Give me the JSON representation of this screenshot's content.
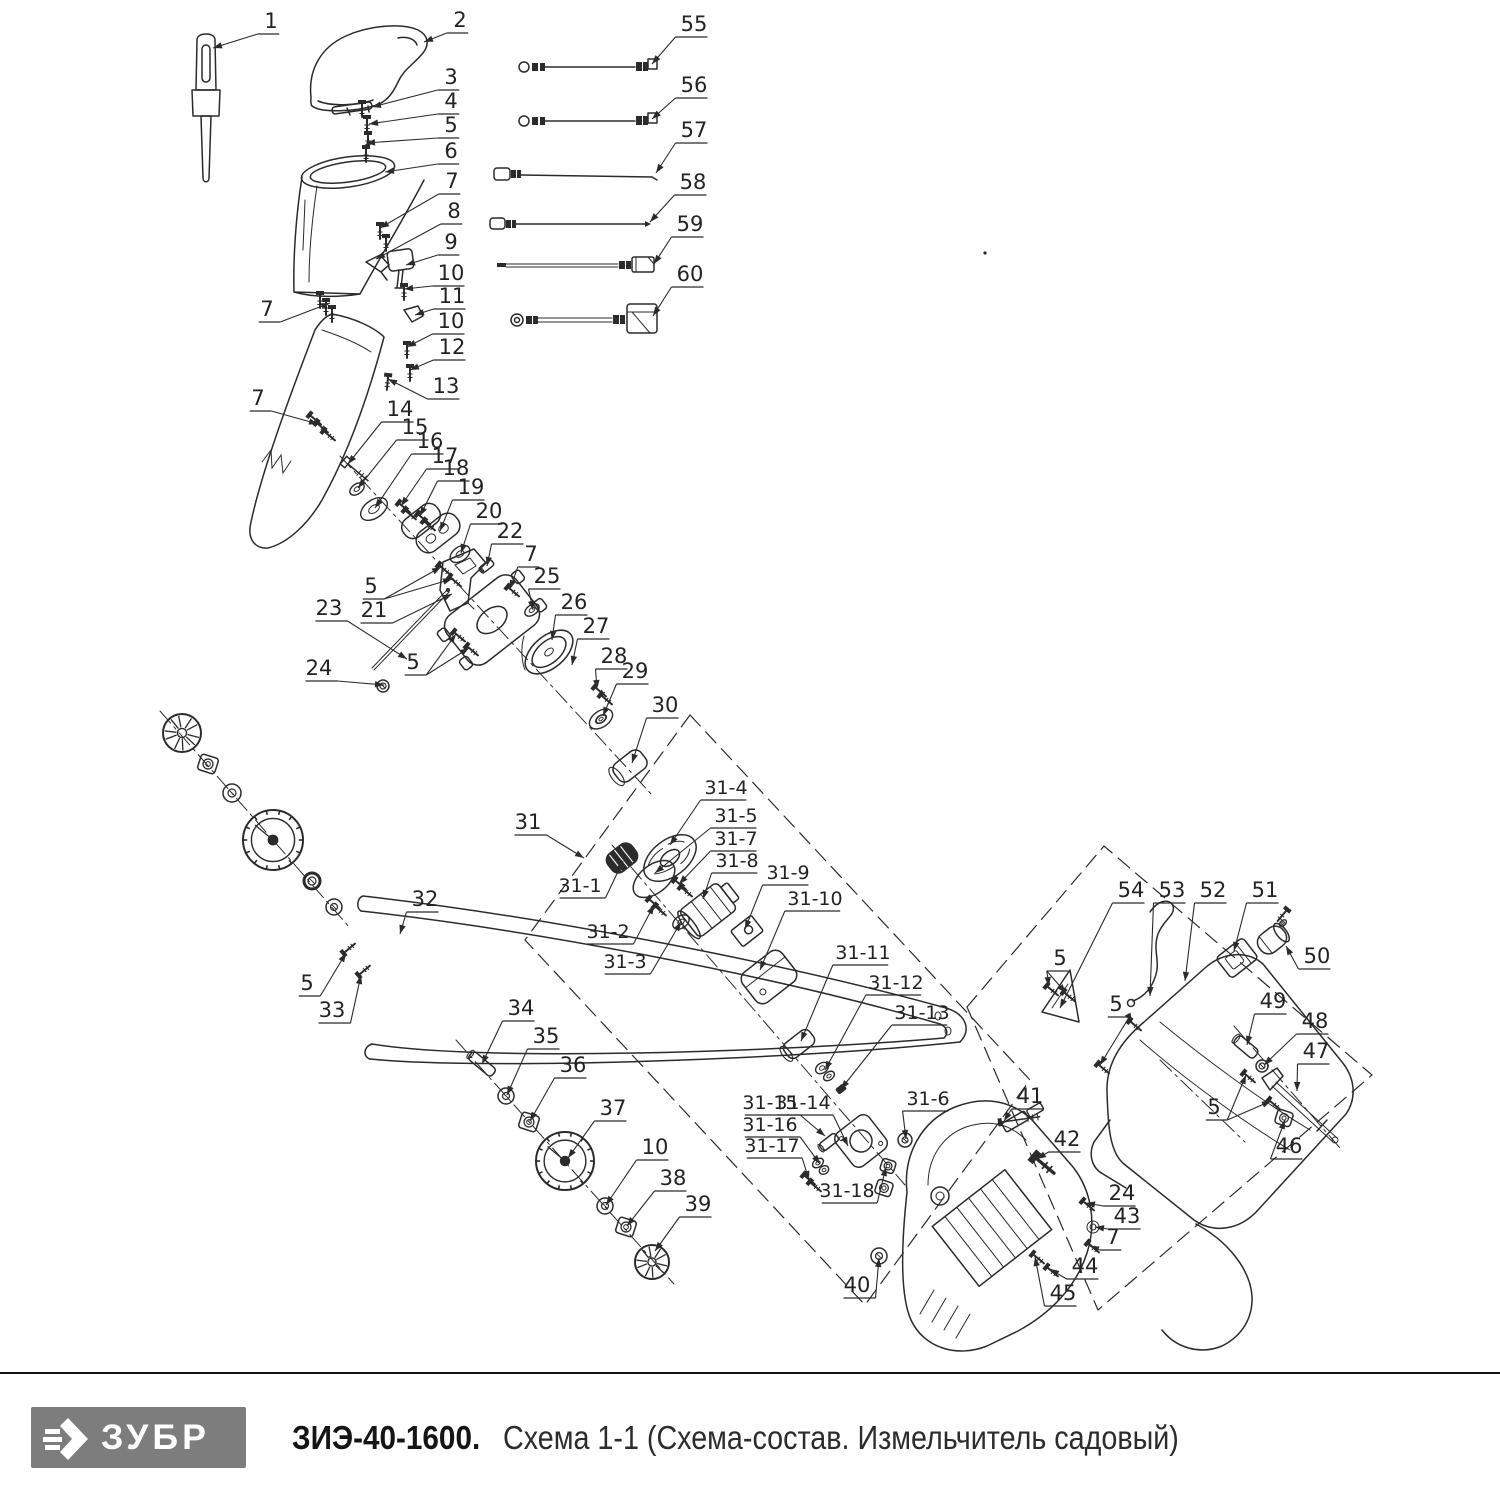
{
  "footer": {
    "brand": "ЗУБР",
    "model": "ЗИЭ-40-1600.",
    "subtitle": "Схема 1-1 (Схема-состав. Измельчитель садовый)"
  },
  "colors": {
    "line": "#2b2b2b",
    "logo_bg": "#7d7d7d",
    "logo_text": "#ffffff",
    "model_color": "#151515",
    "subtitle_color": "#2c2c2c"
  },
  "callouts": [
    {
      "l": "1",
      "x": 271,
      "y": 21,
      "t": [
        [
          213,
          48
        ]
      ]
    },
    {
      "l": "2",
      "x": 460,
      "y": 20,
      "t": [
        [
          424,
          42
        ]
      ]
    },
    {
      "l": "3",
      "x": 451,
      "y": 77,
      "t": [
        [
          372,
          107
        ]
      ]
    },
    {
      "l": "4",
      "x": 451,
      "y": 101,
      "t": [
        [
          369,
          124
        ]
      ]
    },
    {
      "l": "5",
      "x": 451,
      "y": 125,
      "t": [
        [
          366,
          143
        ]
      ]
    },
    {
      "l": "6",
      "x": 451,
      "y": 151,
      "t": [
        [
          385,
          172
        ]
      ]
    },
    {
      "l": "7",
      "x": 452,
      "y": 181,
      "t": [
        [
          380,
          228
        ]
      ]
    },
    {
      "l": "8",
      "x": 454,
      "y": 211,
      "t": [
        [
          376,
          259
        ]
      ]
    },
    {
      "l": "9",
      "x": 451,
      "y": 242,
      "t": [
        [
          406,
          265
        ]
      ]
    },
    {
      "l": "10",
      "x": 451,
      "y": 273,
      "t": [
        [
          404,
          289
        ]
      ]
    },
    {
      "l": "11",
      "x": 452,
      "y": 296,
      "t": [
        [
          415,
          315
        ]
      ]
    },
    {
      "l": "10",
      "x": 451,
      "y": 321,
      "t": [
        [
          407,
          347
        ]
      ]
    },
    {
      "l": "12",
      "x": 452,
      "y": 347,
      "t": [
        [
          410,
          370
        ]
      ]
    },
    {
      "l": "13",
      "x": 446,
      "y": 386,
      "t": [
        [
          388,
          379
        ]
      ]
    },
    {
      "l": "7",
      "x": 267,
      "y": 309,
      "t": [
        [
          330,
          303
        ]
      ]
    },
    {
      "l": "7",
      "x": 258,
      "y": 398,
      "t": [
        [
          318,
          424
        ]
      ]
    },
    {
      "l": "55",
      "x": 694,
      "y": 24,
      "t": [
        [
          652,
          64
        ]
      ]
    },
    {
      "l": "56",
      "x": 694,
      "y": 85,
      "t": [
        [
          652,
          119
        ]
      ]
    },
    {
      "l": "57",
      "x": 694,
      "y": 130,
      "t": [
        [
          656,
          173
        ]
      ]
    },
    {
      "l": "58",
      "x": 693,
      "y": 182,
      "t": [
        [
          650,
          222
        ]
      ]
    },
    {
      "l": "59",
      "x": 690,
      "y": 224,
      "t": [
        [
          654,
          264
        ]
      ]
    },
    {
      "l": "60",
      "x": 690,
      "y": 274,
      "t": [
        [
          653,
          316
        ]
      ]
    },
    {
      "l": "14",
      "x": 400,
      "y": 409,
      "t": [
        [
          348,
          464
        ]
      ]
    },
    {
      "l": "15",
      "x": 415,
      "y": 427,
      "t": [
        [
          358,
          488
        ]
      ]
    },
    {
      "l": "16",
      "x": 430,
      "y": 441,
      "t": [
        [
          375,
          508
        ]
      ]
    },
    {
      "l": "17",
      "x": 445,
      "y": 456,
      "t": [
        [
          401,
          506
        ]
      ]
    },
    {
      "l": "18",
      "x": 456,
      "y": 468,
      "t": [
        [
          420,
          516
        ]
      ]
    },
    {
      "l": "19",
      "x": 471,
      "y": 487,
      "t": [
        [
          440,
          531
        ]
      ]
    },
    {
      "l": "20",
      "x": 489,
      "y": 511,
      "t": [
        [
          461,
          553
        ]
      ]
    },
    {
      "l": "22",
      "x": 510,
      "y": 531,
      "t": [
        [
          487,
          566
        ]
      ]
    },
    {
      "l": "7",
      "x": 531,
      "y": 554,
      "t": [
        [
          510,
          589
        ]
      ]
    },
    {
      "l": "25",
      "x": 547,
      "y": 576,
      "t": [
        [
          533,
          610
        ]
      ]
    },
    {
      "l": "26",
      "x": 574,
      "y": 602,
      "t": [
        [
          552,
          640
        ]
      ]
    },
    {
      "l": "27",
      "x": 596,
      "y": 626,
      "t": [
        [
          572,
          665
        ]
      ]
    },
    {
      "l": "28",
      "x": 614,
      "y": 656,
      "t": [
        [
          597,
          689
        ]
      ]
    },
    {
      "l": "29",
      "x": 635,
      "y": 671,
      "t": [
        [
          603,
          716
        ]
      ]
    },
    {
      "l": "30",
      "x": 665,
      "y": 705,
      "t": [
        [
          632,
          763
        ]
      ]
    },
    {
      "l": "5",
      "x": 371,
      "y": 586,
      "t": [
        [
          441,
          567
        ],
        [
          452,
          579
        ]
      ]
    },
    {
      "l": "21",
      "x": 374,
      "y": 610,
      "t": [
        [
          452,
          594
        ]
      ]
    },
    {
      "l": "23",
      "x": 329,
      "y": 608,
      "t": [
        [
          407,
          659
        ]
      ]
    },
    {
      "l": "24",
      "x": 319,
      "y": 668,
      "t": [
        [
          384,
          685
        ]
      ]
    },
    {
      "l": "5",
      "x": 413,
      "y": 662,
      "t": [
        [
          456,
          634
        ],
        [
          469,
          648
        ]
      ]
    },
    {
      "l": "31",
      "x": 528,
      "y": 822,
      "t": [
        [
          584,
          858
        ]
      ]
    },
    {
      "l": "31-1",
      "x": 580,
      "y": 885,
      "t": [
        [
          623,
          861
        ]
      ]
    },
    {
      "l": "31-2",
      "x": 608,
      "y": 931,
      "t": [
        [
          654,
          905
        ]
      ]
    },
    {
      "l": "31-3",
      "x": 625,
      "y": 961,
      "t": [
        [
          681,
          922
        ]
      ]
    },
    {
      "l": "31-4",
      "x": 726,
      "y": 787,
      "t": [
        [
          670,
          845
        ]
      ]
    },
    {
      "l": "31-5",
      "x": 736,
      "y": 815,
      "t": [
        [
          655,
          873
        ]
      ]
    },
    {
      "l": "31-7",
      "x": 736,
      "y": 838,
      "t": [
        [
          679,
          884
        ]
      ]
    },
    {
      "l": "31-8",
      "x": 737,
      "y": 860,
      "t": [
        [
          703,
          899
        ]
      ]
    },
    {
      "l": "31-9",
      "x": 788,
      "y": 872,
      "t": [
        [
          745,
          929
        ]
      ]
    },
    {
      "l": "31-10",
      "x": 815,
      "y": 898,
      "t": [
        [
          760,
          970
        ]
      ]
    },
    {
      "l": "31-11",
      "x": 863,
      "y": 952,
      "t": [
        [
          801,
          1041
        ]
      ]
    },
    {
      "l": "31-12",
      "x": 896,
      "y": 982,
      "t": [
        [
          825,
          1070
        ]
      ]
    },
    {
      "l": "31-13",
      "x": 922,
      "y": 1012,
      "t": [
        [
          841,
          1089
        ]
      ]
    },
    {
      "l": "31-15",
      "x": 770,
      "y": 1102,
      "t": [
        [
          825,
          1136
        ]
      ]
    },
    {
      "l": "31-14",
      "x": 803,
      "y": 1102,
      "t": [
        [
          848,
          1146
        ]
      ]
    },
    {
      "l": "31-16",
      "x": 770,
      "y": 1124,
      "t": [
        [
          820,
          1164
        ]
      ]
    },
    {
      "l": "31-17",
      "x": 772,
      "y": 1145,
      "t": [
        [
          809,
          1180
        ]
      ]
    },
    {
      "l": "31-18",
      "x": 847,
      "y": 1190,
      "t": [
        [
          886,
          1167
        ]
      ]
    },
    {
      "l": "31-6",
      "x": 928,
      "y": 1098,
      "t": [
        [
          906,
          1139
        ]
      ]
    },
    {
      "l": "32",
      "x": 425,
      "y": 899,
      "t": [
        [
          400,
          934
        ]
      ]
    },
    {
      "l": "5",
      "x": 307,
      "y": 983,
      "t": [
        [
          346,
          953
        ]
      ]
    },
    {
      "l": "33",
      "x": 332,
      "y": 1010,
      "t": [
        [
          361,
          975
        ]
      ]
    },
    {
      "l": "34",
      "x": 521,
      "y": 1008,
      "t": [
        [
          482,
          1064
        ]
      ]
    },
    {
      "l": "35",
      "x": 546,
      "y": 1036,
      "t": [
        [
          507,
          1095
        ]
      ]
    },
    {
      "l": "36",
      "x": 573,
      "y": 1065,
      "t": [
        [
          530,
          1121
        ]
      ]
    },
    {
      "l": "37",
      "x": 613,
      "y": 1108,
      "t": [
        [
          568,
          1158
        ]
      ]
    },
    {
      "l": "10",
      "x": 655,
      "y": 1147,
      "t": [
        [
          606,
          1205
        ]
      ]
    },
    {
      "l": "38",
      "x": 673,
      "y": 1178,
      "t": [
        [
          627,
          1226
        ]
      ]
    },
    {
      "l": "39",
      "x": 698,
      "y": 1204,
      "t": [
        [
          655,
          1251
        ]
      ]
    },
    {
      "l": "40",
      "x": 857,
      "y": 1285,
      "t": [
        [
          879,
          1258
        ]
      ]
    },
    {
      "l": "41",
      "x": 1030,
      "y": 1096,
      "t": [
        [
          1004,
          1121
        ]
      ]
    },
    {
      "l": "42",
      "x": 1067,
      "y": 1139,
      "t": [
        [
          1037,
          1159
        ]
      ]
    },
    {
      "l": "24",
      "x": 1122,
      "y": 1193,
      "t": [
        [
          1086,
          1203
        ]
      ]
    },
    {
      "l": "43",
      "x": 1127,
      "y": 1216,
      "t": [
        [
          1095,
          1227
        ]
      ]
    },
    {
      "l": "7",
      "x": 1113,
      "y": 1237,
      "t": [
        [
          1090,
          1246
        ]
      ]
    },
    {
      "l": "44",
      "x": 1085,
      "y": 1266,
      "t": [
        [
          1050,
          1269
        ]
      ]
    },
    {
      "l": "45",
      "x": 1063,
      "y": 1293,
      "t": [
        [
          1035,
          1257
        ]
      ]
    },
    {
      "l": "54",
      "x": 1131,
      "y": 890,
      "t": [
        [
          1060,
          1008
        ]
      ]
    },
    {
      "l": "53",
      "x": 1172,
      "y": 890,
      "t": [
        [
          1150,
          996
        ]
      ]
    },
    {
      "l": "52",
      "x": 1213,
      "y": 890,
      "t": [
        [
          1185,
          981
        ]
      ]
    },
    {
      "l": "51",
      "x": 1265,
      "y": 890,
      "t": [
        [
          1234,
          951
        ]
      ]
    },
    {
      "l": "50",
      "x": 1317,
      "y": 956,
      "t": [
        [
          1286,
          946
        ]
      ]
    },
    {
      "l": "5",
      "x": 1060,
      "y": 958,
      "t": [
        [
          1049,
          986
        ],
        [
          1066,
          993
        ]
      ]
    },
    {
      "l": "5",
      "x": 1116,
      "y": 1004,
      "t": [
        [
          1132,
          1022
        ],
        [
          1100,
          1065
        ]
      ]
    },
    {
      "l": "49",
      "x": 1273,
      "y": 1001,
      "t": [
        [
          1247,
          1045
        ]
      ]
    },
    {
      "l": "48",
      "x": 1315,
      "y": 1021,
      "t": [
        [
          1264,
          1065
        ]
      ]
    },
    {
      "l": "47",
      "x": 1316,
      "y": 1051,
      "t": [
        [
          1297,
          1091
        ]
      ]
    },
    {
      "l": "5",
      "x": 1214,
      "y": 1107,
      "t": [
        [
          1246,
          1075
        ],
        [
          1271,
          1101
        ]
      ]
    },
    {
      "l": "46",
      "x": 1289,
      "y": 1146,
      "t": [
        [
          1285,
          1120
        ]
      ]
    }
  ]
}
